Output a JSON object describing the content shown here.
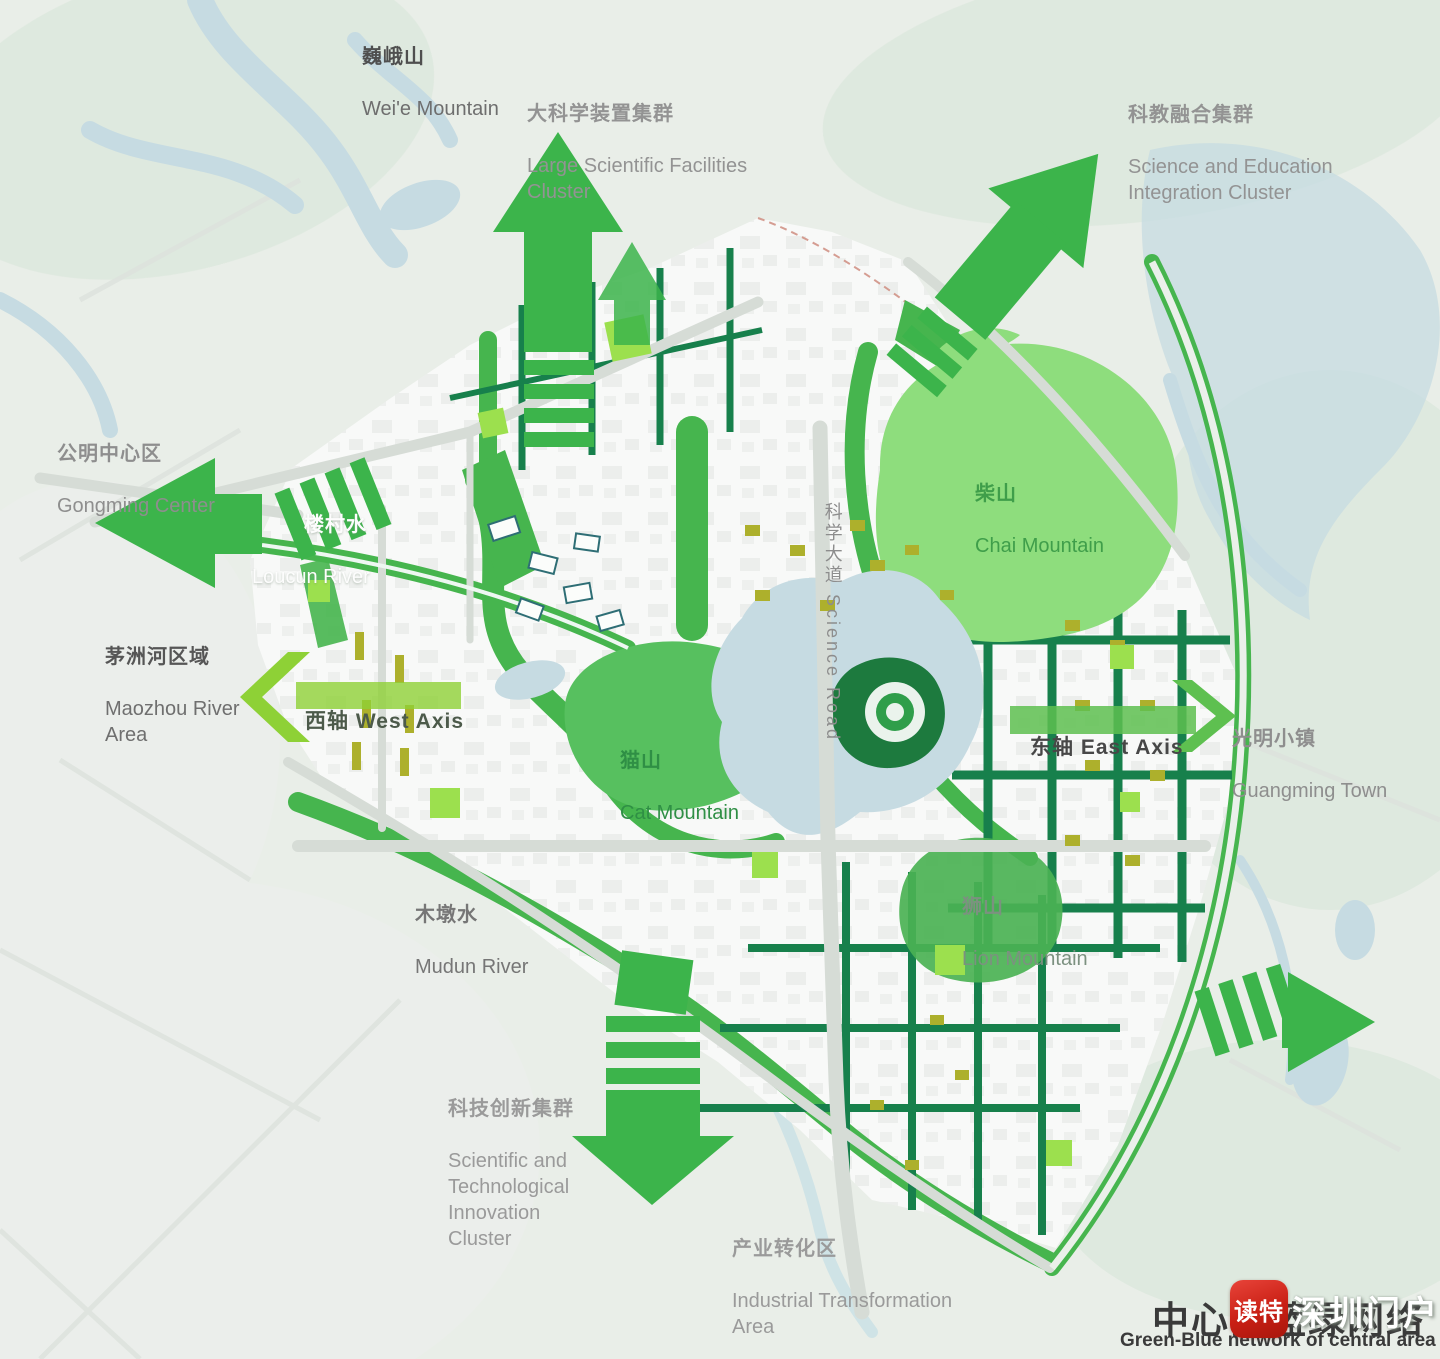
{
  "map": {
    "title": {
      "cn": "中心区蓝绿网络",
      "en": "Green-Blue network of central area"
    },
    "watermark": {
      "app": "读特",
      "brand": "深圳门户"
    },
    "labels": {
      "weie": {
        "cn": "巍峨山",
        "en": "Wei'e Mountain"
      },
      "large_sci": {
        "cn": "大科学装置集群",
        "en": "Large Scientific Facilities\nCluster"
      },
      "sci_edu": {
        "cn": "科教融合集群",
        "en": "Science and Education\nIntegration Cluster"
      },
      "gongming": {
        "cn": "公明中心区",
        "en": "Gongming Center"
      },
      "loucun": {
        "cn": "楼村水",
        "en": "Loucun River"
      },
      "maozhou": {
        "cn": "茅洲河区域",
        "en": "Maozhou River\nArea"
      },
      "west_axis": {
        "text": "西轴 West Axis"
      },
      "east_axis": {
        "text": "东轴 East Axis"
      },
      "science_road": {
        "text": "科学大道 Science Road"
      },
      "cat": {
        "cn": "猫山",
        "en": "Cat Mountain"
      },
      "chai": {
        "cn": "柴山",
        "en": "Chai Mountain"
      },
      "lion": {
        "cn": "狮山",
        "en": "Lion Mountain"
      },
      "guangming": {
        "cn": "光明小镇",
        "en": "Guangming Town"
      },
      "mudun": {
        "cn": "木墩水",
        "en": "Mudun River"
      },
      "sci_innov": {
        "cn": "科技创新集群",
        "en": "Scientific and\nTechnological\nInnovation\nCluster"
      },
      "industrial": {
        "cn": "产业转化区",
        "en": "Industrial Transformation\nArea"
      }
    }
  },
  "colors": {
    "background": "#e9eee8",
    "celadon": "#d9e6da",
    "pale": "#edefec",
    "water": "#c6dbe2",
    "stream": "#cfe3e6",
    "fabric": "#f8f9f8",
    "road": "#d6dcd6",
    "corridor": "#46b54e",
    "corridor_dark": "#17804c",
    "mountain_light": "#8edd7d",
    "mountain_mid": "#57c05f",
    "mountain_lion": "#4bb254",
    "arrow": "#3cb44b",
    "axis_west": "#8ed136",
    "axis_east": "#5ec050",
    "olive": "#adb02c",
    "lime": "#9ce04e",
    "eye_dark": "#1d7a3e",
    "eye_ring": "#eaf3ec",
    "eye_center": "#2f9e4a"
  }
}
